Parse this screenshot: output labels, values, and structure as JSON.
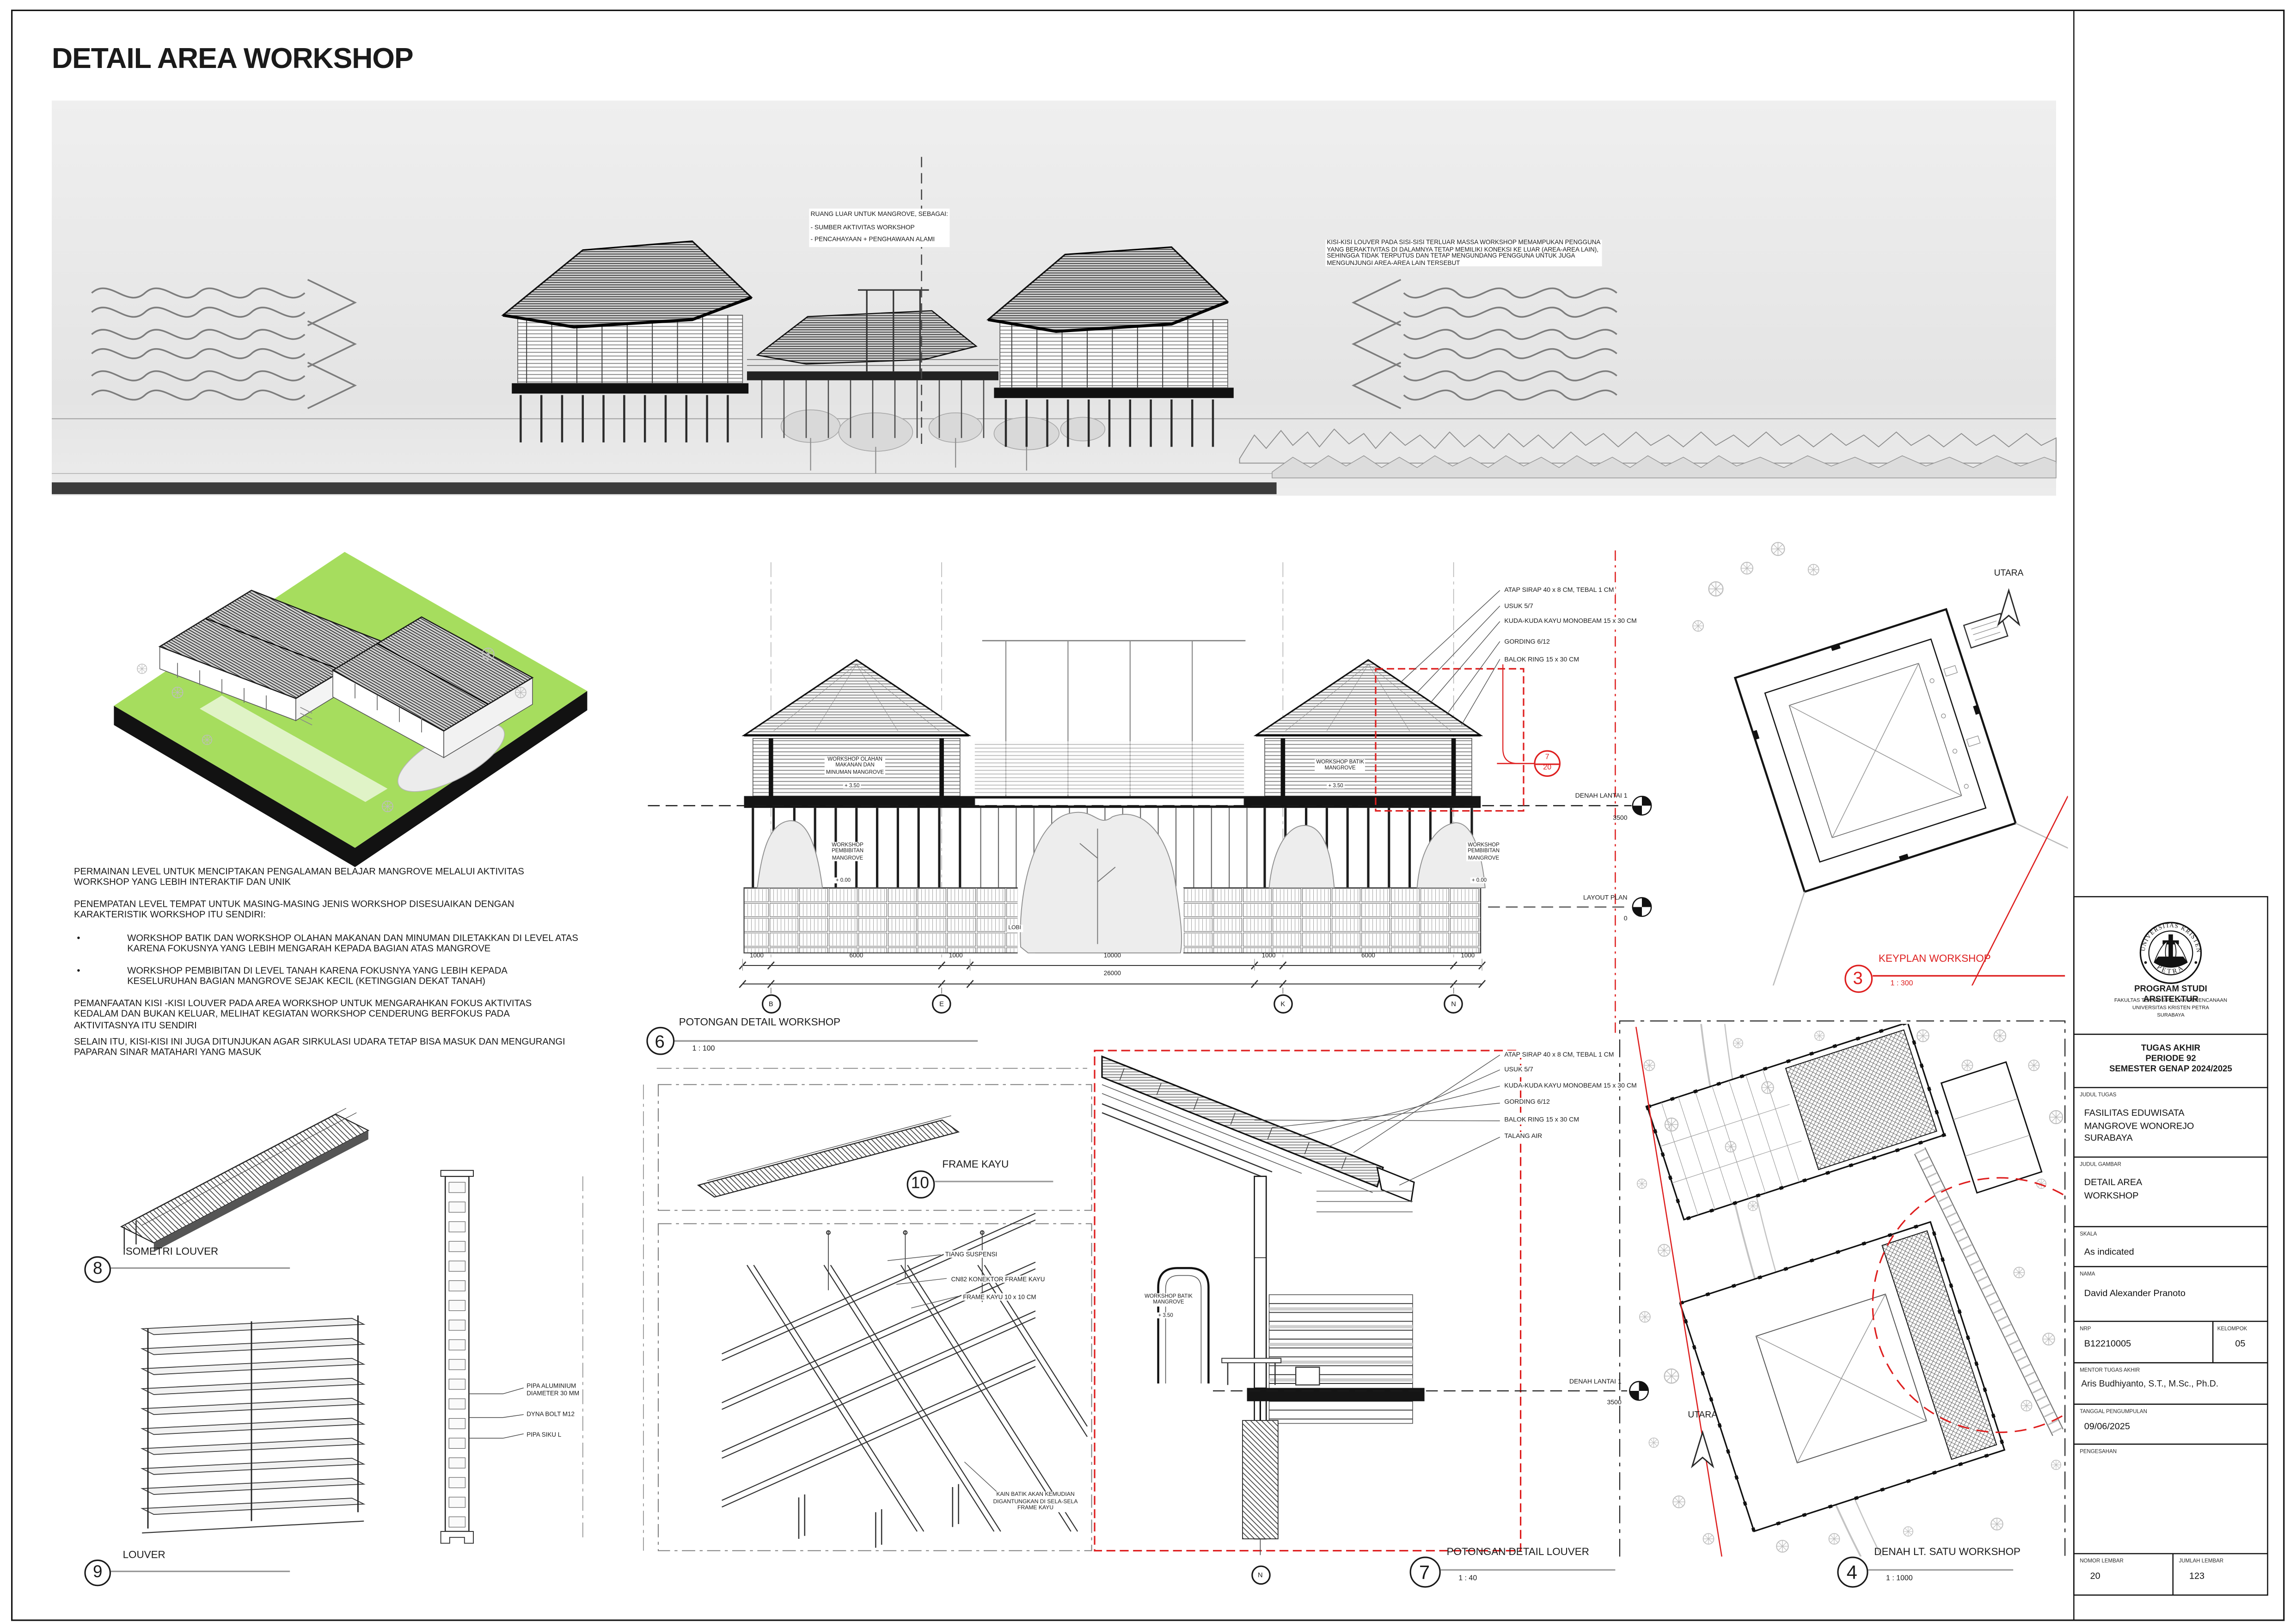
{
  "colors": {
    "accent_red": "#de1f1f",
    "site_green": "#a6dd5e"
  },
  "sheet": {
    "title": "DETAIL AREA WORKSHOP"
  },
  "top_view": {
    "note_left": "RUANG LUAR UNTUK MANGROVE, SEBAGAI:\n- SUMBER AKTIVITAS WORKSHOP\n- PENCAHAYAAN + PENGHAWAAN ALAMI",
    "note_right": "KISI-KISI LOUVER PADA SISI-SISI TERLUAR MASSA WORKSHOP MEMAMPUKAN PENGGUNA\nYANG BERAKTIVITAS DI DALAMNYA TETAP MEMILIKI KONEKSI KE LUAR (AREA-AREA LAIN),\nSEHINGGA TIDAK TERPUTUS DAN TETAP MENGUNDANG PENGGUNA UNTUK JUGA\nMENGUNJUNGI AREA-AREA LAIN TERSEBUT"
  },
  "notes": {
    "bullet": "•",
    "p1": "PERMAINAN LEVEL UNTUK MENCIPTAKAN PENGALAMAN BELAJAR MANGROVE MELALUI AKTIVITAS\nWORKSHOP YANG LEBIH INTERAKTIF DAN UNIK",
    "p2": "PENEMPATAN LEVEL TEMPAT UNTUK MASING-MASING JENIS WORKSHOP DISESUAIKAN DENGAN\nKARAKTERISTIK WORKSHOP ITU SENDIRI:",
    "b1": "WORKSHOP BATIK DAN WORKSHOP OLAHAN MAKANAN DAN MINUMAN DILETAKKAN DI LEVEL ATAS\nKARENA FOKUSNYA YANG LEBIH MENGARAH KEPADA BAGIAN ATAS MANGROVE",
    "b2": "WORKSHOP PEMBIBITAN DI LEVEL TANAH KARENA FOKUSNYA YANG LEBIH KEPADA\nKESELURUHAN BAGIAN MANGROVE SEJAK KECIL (KETINGGIAN DEKAT TANAH)",
    "p3": "PEMANFAATAN KISI -KISI LOUVER PADA AREA WORKSHOP UNTUK MENGARAHKAN FOKUS AKTIVITAS\nKEDALAM DAN BUKAN KELUAR, MELIHAT KEGIATAN WORKSHOP CENDERUNG BERFOKUS PADA\nAKTIVITASNYA ITU SENDIRI",
    "p4": "SELAIN ITU, KISI-KISI INI JUGA DITUNJUKAN AGAR SIRKULASI UDARA TETAP BISA MASUK DAN MENGURANGI\nPAPARAN SINAR MATAHARI YANG MASUK"
  },
  "section": {
    "num": "6",
    "title": "POTONGAN DETAIL WORKSHOP",
    "scale": "1 : 100",
    "annotations": [
      "ATAP SIRAP 40 x 8 CM, TEBAL 1 CM",
      "USUK 5/7",
      "KUDA-KUDA KAYU MONOBEAM 15 x 30 CM",
      "GORDING 6/12",
      "BALOK RING 15 x 30 CM"
    ],
    "room_olahan": "WORKSHOP OLAHAN\nMAKANAN DAN\nMINUMAN MANGROVE",
    "room_batik": "WORKSHOP BATIK\nMANGROVE",
    "room_pembibitan": "WORKSHOP\nPEMBIBITAN\nMANGROVE",
    "lobi": "LOBI",
    "lv_350": "+ 3.50",
    "lv_000": "+ 0.00",
    "level_denah": "DENAH LANTAI 1",
    "level_denah_val": "3500",
    "level_layout": "LAYOUT PLAN",
    "level_layout_val": "0",
    "ref_num": "7",
    "ref_sheet": "20",
    "dims": [
      "1000",
      "6000",
      "1000",
      "10000",
      "1000",
      "6000",
      "1000"
    ],
    "dims_total": "26000",
    "grid": [
      "B",
      "E",
      "K",
      "N"
    ]
  },
  "keyplan": {
    "num": "3",
    "title": "KEYPLAN WORKSHOP",
    "scale": "1 : 300",
    "utara": "UTARA"
  },
  "siteplan": {
    "num": "4",
    "title": "DENAH LT. SATU WORKSHOP",
    "scale": "1 : 1000",
    "utara": "UTARA"
  },
  "louver_iso": {
    "num": "8",
    "title": "ISOMETRI LOUVER"
  },
  "louver": {
    "num": "9",
    "title": "LOUVER",
    "ann_pipa": "PIPA ALUMINIUM\nDIAMETER 30 MM",
    "ann_dyna": "DYNA BOLT M12",
    "ann_siku": "PIPA SIKU L"
  },
  "frame": {
    "num": "10",
    "title": "FRAME KAYU",
    "ann_tiang": "TIANG SUSPENSI",
    "ann_cn82": "CN82 KONEKTOR FRAME KAYU",
    "ann_kayu": "FRAME KAYU 10 x 10 CM",
    "ann_kain": "KAIN BATIK AKAN KEMUDIAN\nDIGANTUNGKAN DI SELA-SELA\nFRAME KAYU"
  },
  "detail_louver": {
    "num": "7",
    "title": "POTONGAN DETAIL LOUVER",
    "scale": "1 : 40",
    "annotations": [
      "ATAP SIRAP 40 x 8 CM, TEBAL 1 CM",
      "USUK 5/7",
      "KUDA-KUDA KAYU MONOBEAM 15 x 30 CM",
      "GORDING 6/12",
      "BALOK RING 15 x 30 CM",
      "TALANG AIR"
    ],
    "room_batik": "WORKSHOP BATIK\nMANGROVE",
    "lv_350": "+ 3.50",
    "level_denah": "DENAH LANTAI 1",
    "level_denah_val": "3500",
    "grid_n": "N"
  },
  "titleblock": {
    "logo_top": "UNIVERSITAS KRISTEN",
    "logo_bottom": "PETRA",
    "program": "PROGRAM STUDI ARSITEKTUR",
    "fakultas": "FAKULTAS TEKNIK SIPIL DAN PERENCANAAN",
    "universitas": "UNIVERSITAS KRISTEN PETRA",
    "kota": "SURABAYA",
    "tugas": "TUGAS AKHIR\nPERIODE 92\nSEMESTER GENAP 2024/2025",
    "judul_tugas_label": "JUDUL TUGAS",
    "judul_tugas": "FASILITAS EDUWISATA\nMANGROVE WONOREJO\nSURABAYA",
    "judul_gambar_label": "JUDUL GAMBAR",
    "judul_gambar": "DETAIL AREA\nWORKSHOP",
    "skala_label": "SKALA",
    "skala": "As indicated",
    "nama_label": "NAMA",
    "nama": "David Alexander Pranoto",
    "nrp_label": "NRP",
    "nrp": "B12210005",
    "kelompok_label": "KELOMPOK",
    "kelompok": "05",
    "mentor_label": "MENTOR TUGAS AKHIR",
    "mentor": "Aris Budhiyanto, S.T., M.Sc., Ph.D.",
    "tanggal_label": "TANGGAL PENGUMPULAN",
    "tanggal": "09/06/2025",
    "pengesahan_label": "PENGESAHAN",
    "nomor_label": "NOMOR LEMBAR",
    "nomor": "20",
    "jumlah_label": "JUMLAH LEMBAR",
    "jumlah": "123"
  }
}
